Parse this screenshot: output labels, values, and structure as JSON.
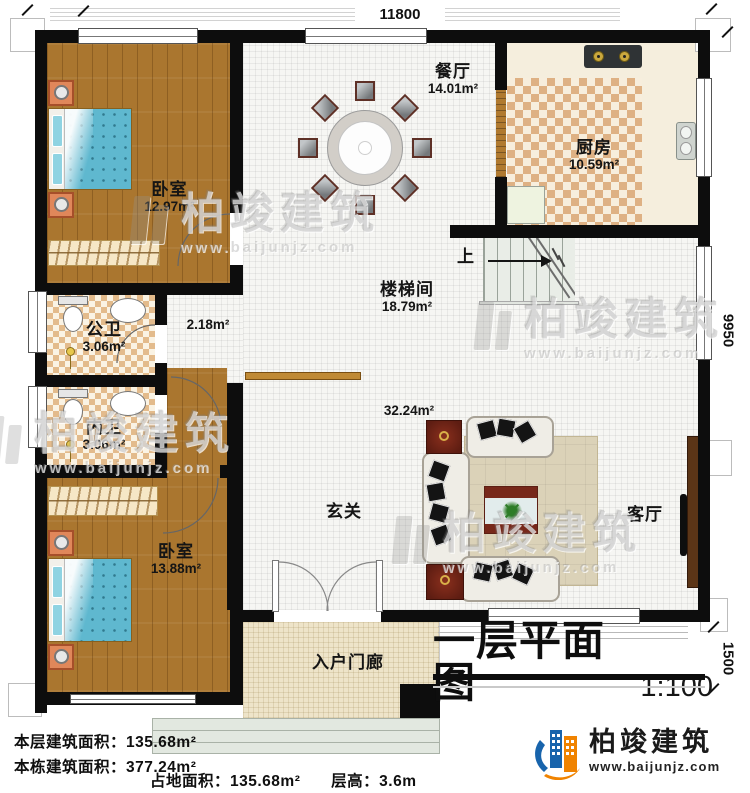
{
  "title_block": {
    "title": "一层平面图",
    "scale": "1:100"
  },
  "dimensions": {
    "top": "11800",
    "right": "9950",
    "right_lower": "1500"
  },
  "rooms": {
    "bedroom1": {
      "name": "卧室",
      "area": "12.97m²"
    },
    "dining": {
      "name": "餐厅",
      "area": "14.01m²"
    },
    "kitchen": {
      "name": "厨房",
      "area": "10.59m²"
    },
    "stairwell": {
      "name": "楼梯间",
      "area": "18.79m²"
    },
    "hall_passage": {
      "area": "2.18m²"
    },
    "public_bath": {
      "name": "公卫",
      "area": "3.06m²"
    },
    "inner_bath": {
      "name": "内卫",
      "area": "3.06m²"
    },
    "bedroom2": {
      "name": "卧室",
      "area": "13.88m²"
    },
    "foyer": {
      "name": "玄关"
    },
    "living": {
      "name": "客厅",
      "area": "32.24m²"
    },
    "porch": {
      "name": "入户门廊"
    }
  },
  "stairs": {
    "direction_label": "上"
  },
  "footer": {
    "floor_area_line": "本层建筑面积：135.68m²",
    "building_area_line": "本栋建筑面积：377.24m²",
    "footprint_line": "占地面积：135.68m²",
    "floor_height_line": "层高：3.6m"
  },
  "logo": {
    "company": "柏竣建筑",
    "website": "www.baijunjz.com"
  },
  "watermark": {
    "text": "柏竣建筑",
    "url": "www.baijunjz.com"
  },
  "colors": {
    "wall": "#0d0d0d",
    "wood_floor": "#aa762f",
    "kitchen_tile": "#deb184",
    "bed_fabric": "#5fb8cf",
    "logo_orange": "#f08300",
    "logo_blue": "#1864ac"
  }
}
